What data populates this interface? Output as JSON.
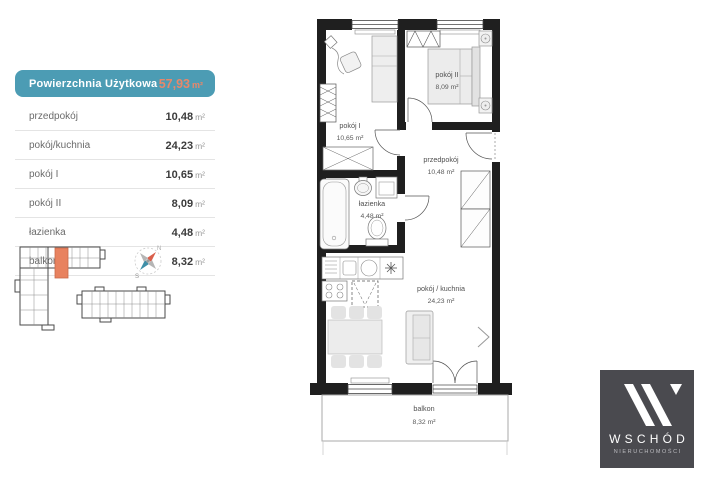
{
  "panel": {
    "header": {
      "label": "Powierzchnia Użytkowa",
      "value": "57,93",
      "unit": "m²"
    },
    "rows": [
      {
        "label": "przedpokój",
        "value": "10,48",
        "unit": "m²"
      },
      {
        "label": "pokój/kuchnia",
        "value": "24,23",
        "unit": "m²"
      },
      {
        "label": "pokój I",
        "value": "10,65",
        "unit": "m²"
      },
      {
        "label": "pokój II",
        "value": "8,09",
        "unit": "m²"
      },
      {
        "label": "łazienka",
        "value": "4,48",
        "unit": "m²"
      },
      {
        "label": "balkon",
        "value": "8,32",
        "unit": "m²"
      }
    ]
  },
  "plan": {
    "rooms": [
      {
        "name": "pokój I",
        "area": "10,65 m²"
      },
      {
        "name": "pokój II",
        "area": "8,09 m²"
      },
      {
        "name": "przedpokój",
        "area": "10,48 m²"
      },
      {
        "name": "łazienka",
        "area": "4,48 m²"
      },
      {
        "name": "pokój / kuchnia",
        "area": "24,23 m²"
      },
      {
        "name": "balkon",
        "area": "8,32 m²"
      }
    ]
  },
  "compass": {
    "north": "N",
    "south": "S"
  },
  "logo": {
    "name": "WSCHÓD",
    "tagline": "NIERUCHOMOŚCI"
  },
  "colors": {
    "teal_header": "#4c9cb4",
    "orange_accent": "#e8876a",
    "wall": "#1f1f1f",
    "unit_highlight": "#e8825f",
    "logo_background": "#4a4a4f"
  }
}
